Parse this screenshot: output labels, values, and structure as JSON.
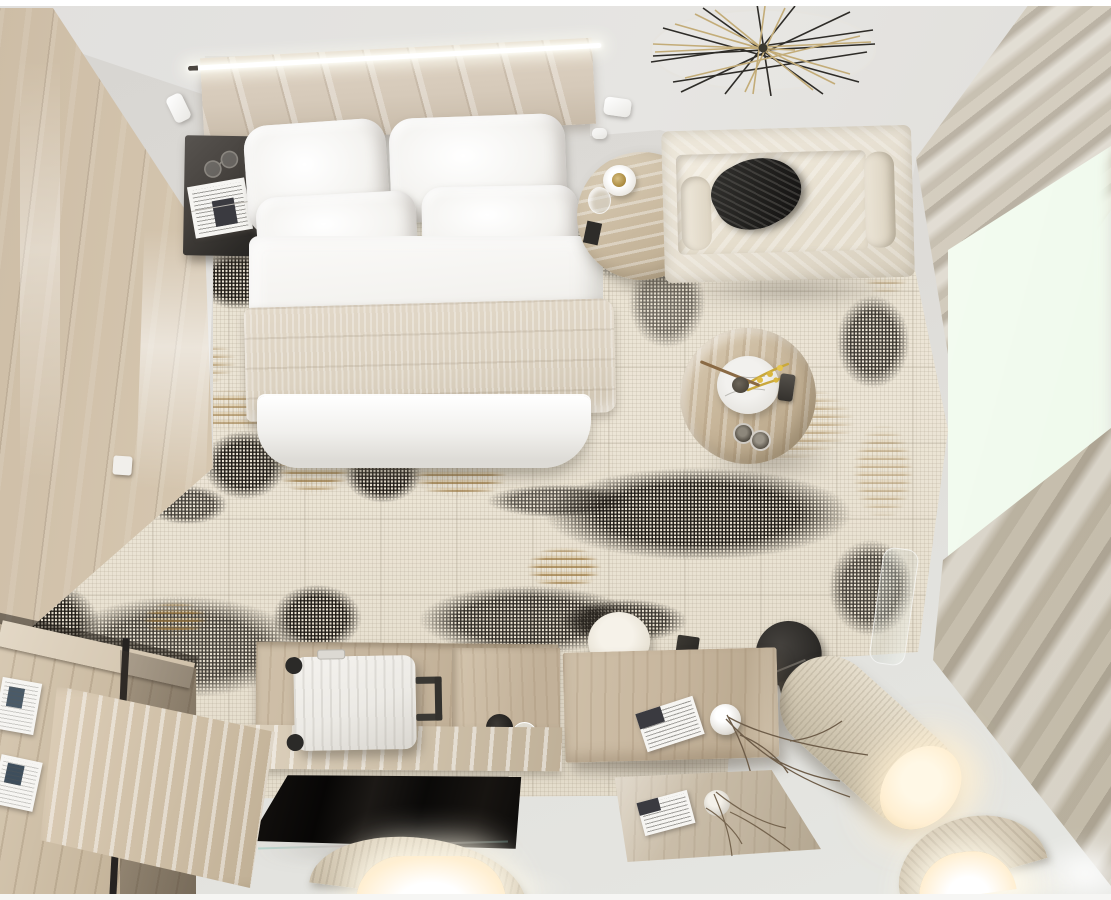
{
  "scene": {
    "type": "3d interior render",
    "view": "top-down bird's-eye",
    "room": "modern hotel bedroom in beige, black and gold tones",
    "width_px": 1111,
    "height_px": 900
  },
  "palette": {
    "floor": "#d7d5d1",
    "ceiling": "#e1e0de",
    "wood_wall": "#d8c9b2",
    "rug_base": "#e9e2d3",
    "rug_black": "#1c1915",
    "rug_gold": "#a5824a",
    "bedding_white": "#f4f3f0",
    "blanket_beige": "#dcd2c1",
    "headboard_velvet": "#d6cabA",
    "sofa_cream": "#e7e0d2",
    "pillow_black": "#201f1d",
    "curtain": "#d5cec0",
    "window_glow": "#f8fef5",
    "furniture_wood": "#c8b79f",
    "tv_black": "#0e0c0b",
    "suitcase_white": "#eceae5",
    "metal_black": "#2e2c29",
    "lamp_glow": "#ffefd2",
    "gold_wire": "#c3ac78",
    "wire_black": "#2e2c28"
  },
  "objects": {
    "ceiling": {
      "label": "ceiling with linear LED light and spotlights"
    },
    "wood_wall": {
      "label": "wood plank accent wall"
    },
    "led_strip": {
      "label": "linear LED cove light above headboard"
    },
    "headboard": {
      "label": "channel-tufted velvet headboard wall panel"
    },
    "bed": {
      "label": "double bed with white duvet",
      "pillow_count": 4
    },
    "blanket": {
      "label": "beige textured throw blanket"
    },
    "nightstand": {
      "label": "black bedside cabinet",
      "items": [
        "newspaper",
        "eyeglasses"
      ]
    },
    "side_table": {
      "label": "round travertine side table",
      "items": [
        "candle plate",
        "glass"
      ]
    },
    "sofa": {
      "label": "cream velvet sofa",
      "items": [
        "black crumpled pillow"
      ]
    },
    "chandelier": {
      "label": "round geometric wire chandelier in black and gold"
    },
    "spotlights": {
      "label": "white ceiling spotlights",
      "count": 3
    },
    "rug": {
      "label": "abstract patchwork rug in beige, black and gold"
    },
    "coffee_table": {
      "label": "round wooden coffee table",
      "items": [
        "marble plate",
        "yellow mimosa sprigs",
        "dark bowl",
        "remote control",
        "two cups"
      ]
    },
    "pouf": {
      "label": "white cylindrical pouf"
    },
    "black_chair": {
      "label": "black sculptural arch chair"
    },
    "cylinder_lamp": {
      "label": "fabric cylinder floor lamp, lit end"
    },
    "curtains": {
      "label": "beige roman-shade curtains on window wall"
    },
    "window_light": {
      "label": "bright daylight glow from window"
    },
    "desk": {
      "label": "wooden desk",
      "items": [
        "magazine",
        "white sphere vase",
        "dry branches"
      ]
    },
    "floor_mirror": {
      "label": "wooden-framed floor mirror reflecting the desk"
    },
    "console": {
      "label": "wooden luggage console along bottom wall"
    },
    "suitcase": {
      "label": "white ribbed suitcase with black wheels and handle"
    },
    "tv": {
      "label": "flat black TV screen seen from above"
    },
    "shelf_unit": {
      "label": "low wood and black-metal shelf",
      "items": [
        "magazines"
      ]
    },
    "step_platform": {
      "label": "wooden step platform"
    },
    "sconce_left": {
      "label": "glowing half-cylinder wall lamp (left)"
    },
    "sconce_right": {
      "label": "glowing half-cylinder wall lamp (right)"
    },
    "light_switch": {
      "label": "white light switch on wood wall"
    },
    "glass_vase": {
      "label": "clear glass vase near window"
    }
  }
}
